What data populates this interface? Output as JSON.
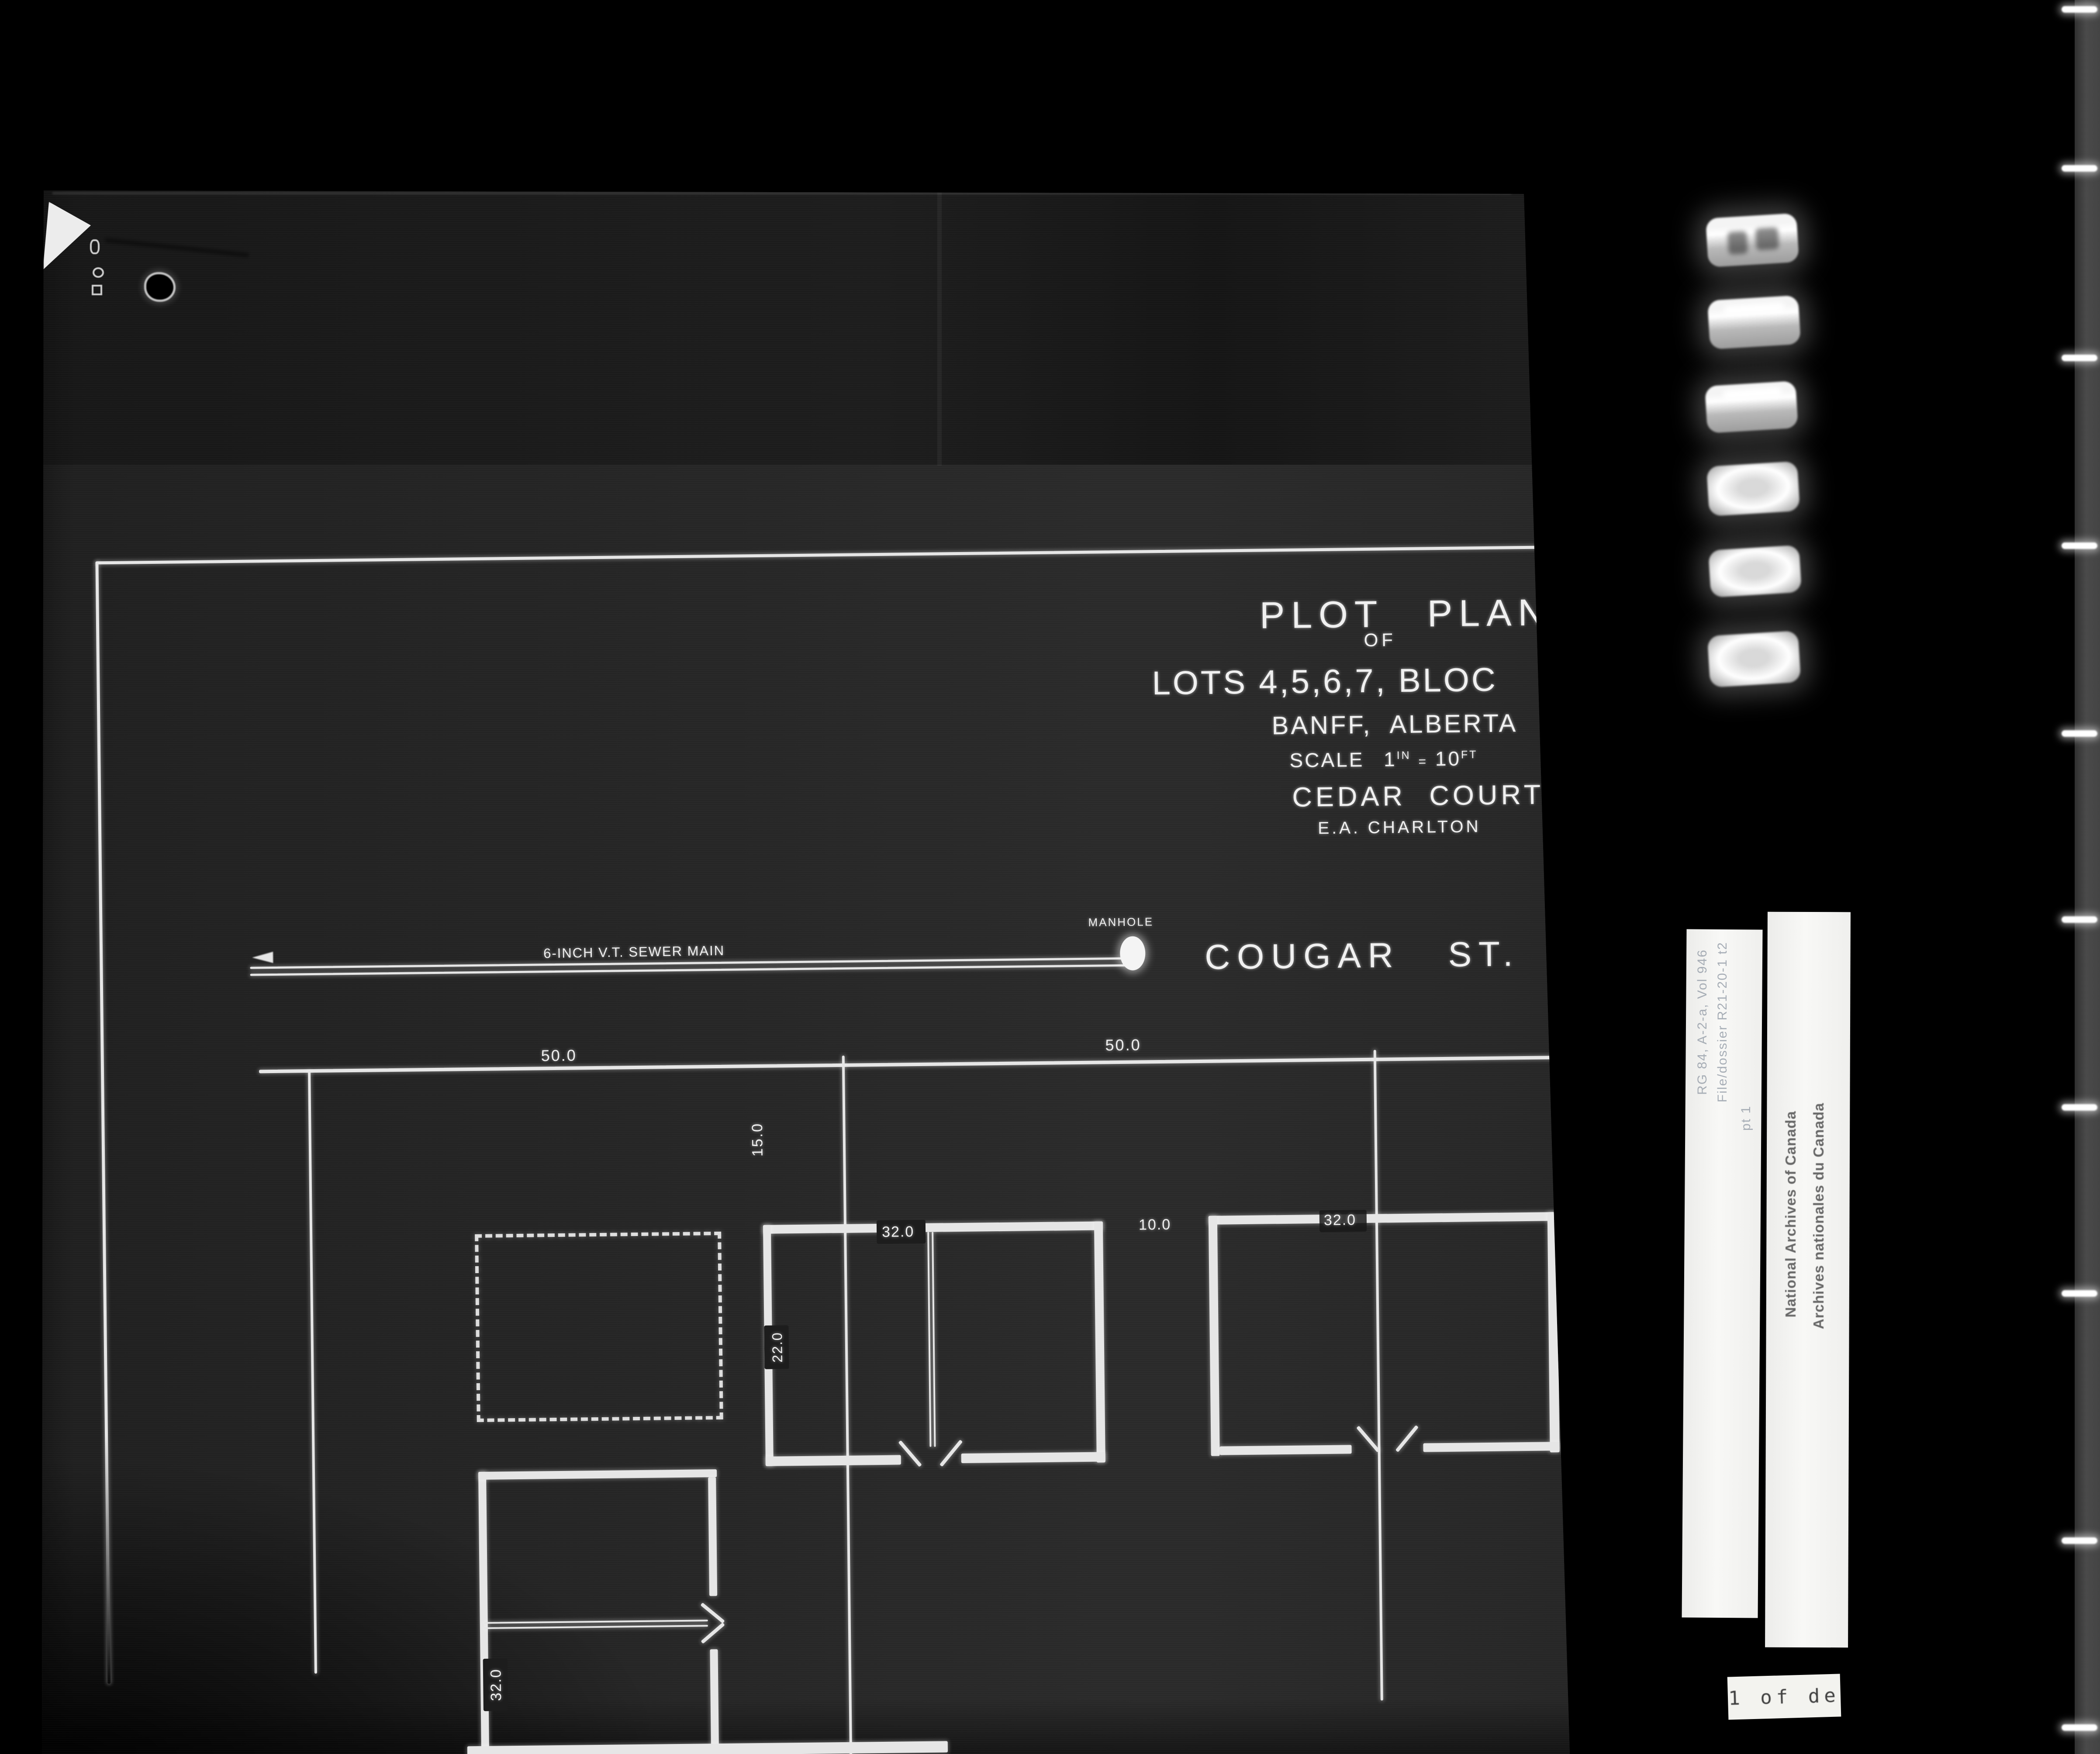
{
  "title": {
    "plot_plan": "PLOT PLAN",
    "of": "OF",
    "lots": "LOTS 4,5,6,7, BLOC",
    "location": "BANFF, ALBERTA",
    "scale": {
      "label": "SCALE",
      "value1": "1",
      "unit1": "IN",
      "equals": "=",
      "value2": "10",
      "unit2": "FT"
    },
    "project": "CEDAR COURT",
    "author": "E.A. CHARLTON"
  },
  "plan": {
    "street": "COUGAR ST.",
    "sewer_main": "6-INCH V.T. SEWER MAIN",
    "manhole": "MANHOLE",
    "dimensions": {
      "frontage_left": "50.0",
      "frontage_right": "50.0",
      "setback": "15.0",
      "building1_width": "32.0",
      "building_gap": "10.0",
      "building2_width": "32.0",
      "building1_depth": "22.0",
      "building3_width": "32.0"
    }
  },
  "archive": {
    "film_strip_label": {
      "line1": "RG 84, A-2-a, Vol 946",
      "line2": "File/dossier R21-20-1 t2",
      "line3": "pt 1"
    },
    "stamp": {
      "english": "National Archives of Canada",
      "french": "Archives nationales du Canada"
    },
    "page_label": "1 of de"
  },
  "colors": {
    "background": "#000000",
    "photo_base": "#262626",
    "line_white": "#e8e8e8",
    "label_paper": "#f4f4f2",
    "stamp_text": "#4f4f4f"
  }
}
